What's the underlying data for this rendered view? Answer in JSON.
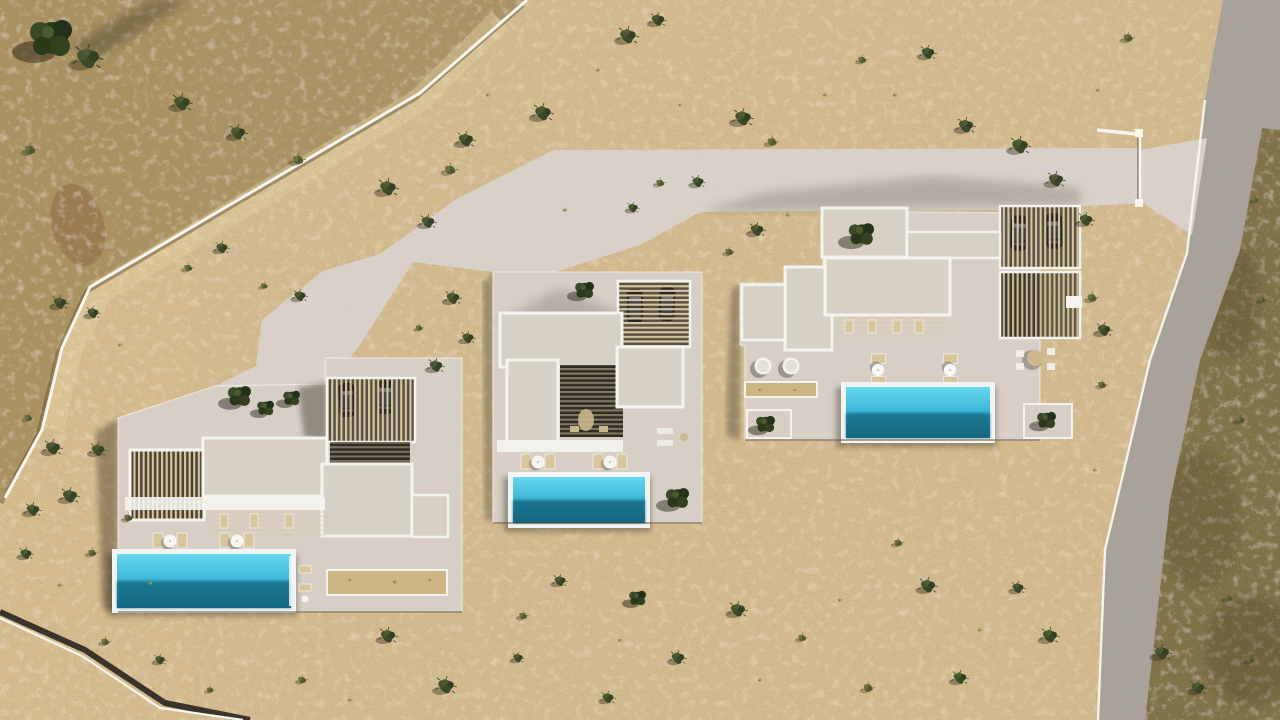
{
  "meta": {
    "title": "Aerial site plan render - three luxury villas with pools",
    "description": "Top-down architectural rendering of a desert plot with three white flat-roof villas, each with a turquoise swimming pool, louvered carport with two cars, sun loungers, a shared light-concrete driveway, white boundary walls and an asphalt access road on the right."
  },
  "palette": {
    "sand": "#d8be90",
    "sandOuter": "#ab9260",
    "scrub": "#7d6c40",
    "road": "#a7a199",
    "drive": "#dbd3cb",
    "platform": "#d7cfc6",
    "roof": "#d6d0c5",
    "frame": "#f5f3ee",
    "slat": "#d8c79e",
    "court": "#2e2b25",
    "carbase": "#454034",
    "poolHi": "#68d7ee",
    "poolMid": "#35b2d4",
    "poolDeep": "#156881",
    "rim": "#f2f4f3",
    "gravel": "#cdb483",
    "wall": "#f8f5ef",
    "bush": "#3c4a29",
    "bushLite": "#46552f",
    "olive": "#5a6334",
    "tuft": "#9a975f",
    "tree": "#2e3b1f",
    "car": "#242428"
  },
  "scene": {
    "villa_count": 3,
    "villas": [
      {
        "name": "villa-west",
        "pool": {
          "x": 112,
          "y": 549,
          "w": 184,
          "h": 64
        },
        "cars": 2,
        "sun_lounger_groups": 2
      },
      {
        "name": "villa-center",
        "pool": {
          "x": 508,
          "y": 472,
          "w": 142,
          "h": 56
        },
        "cars": 2,
        "sun_lounger_groups": 2
      },
      {
        "name": "villa-east",
        "pool": {
          "x": 841,
          "y": 382,
          "w": 154,
          "h": 61
        },
        "cars": 2,
        "sun_lounger_groups": 2
      }
    ],
    "vegetation": [
      [
        52,
        38,
        2.0,
        "tree"
      ],
      [
        88,
        58,
        1.4,
        "bush"
      ],
      [
        30,
        150,
        0.8,
        "olive"
      ],
      [
        182,
        103,
        1.0,
        "bush"
      ],
      [
        238,
        133,
        0.9,
        "bush"
      ],
      [
        298,
        160,
        0.8,
        "olive"
      ],
      [
        388,
        188,
        1.0,
        "bush"
      ],
      [
        428,
        222,
        0.8,
        "bush"
      ],
      [
        466,
        140,
        0.9,
        "bush"
      ],
      [
        450,
        170,
        0.8,
        "olive"
      ],
      [
        543,
        113,
        1.0,
        "bush"
      ],
      [
        628,
        36,
        1.0,
        "bush"
      ],
      [
        658,
        20,
        0.8,
        "bush"
      ],
      [
        743,
        118,
        1.0,
        "bush"
      ],
      [
        772,
        142,
        0.7,
        "olive"
      ],
      [
        698,
        182,
        0.7,
        "bush"
      ],
      [
        660,
        183,
        0.6,
        "olive"
      ],
      [
        633,
        208,
        0.6,
        "bush"
      ],
      [
        565,
        210,
        0.5,
        "tuft"
      ],
      [
        488,
        95,
        0.5,
        "tuft"
      ],
      [
        598,
        70,
        0.5,
        "tuft"
      ],
      [
        680,
        105,
        0.4,
        "tuft"
      ],
      [
        825,
        95,
        0.5,
        "tuft"
      ],
      [
        862,
        60,
        0.6,
        "olive"
      ],
      [
        895,
        95,
        0.5,
        "tuft"
      ],
      [
        928,
        53,
        0.8,
        "bush"
      ],
      [
        966,
        126,
        0.9,
        "bush"
      ],
      [
        1020,
        146,
        1.0,
        "bush"
      ],
      [
        1056,
        180,
        0.9,
        "bush"
      ],
      [
        1086,
        220,
        0.8,
        "bush"
      ],
      [
        1128,
        38,
        0.7,
        "olive"
      ],
      [
        1098,
        90,
        0.5,
        "tuft"
      ],
      [
        1104,
        330,
        0.8,
        "bush"
      ],
      [
        1092,
        298,
        0.7,
        "olive"
      ],
      [
        1102,
        385,
        0.6,
        "olive"
      ],
      [
        1095,
        470,
        0.5,
        "tuft"
      ],
      [
        757,
        230,
        0.8,
        "bush"
      ],
      [
        729,
        252,
        0.6,
        "olive"
      ],
      [
        788,
        215,
        0.5,
        "tuft"
      ],
      [
        453,
        298,
        0.8,
        "bush"
      ],
      [
        468,
        338,
        0.7,
        "bush"
      ],
      [
        436,
        366,
        0.8,
        "bush"
      ],
      [
        419,
        328,
        0.5,
        "olive"
      ],
      [
        300,
        296,
        0.7,
        "bush"
      ],
      [
        264,
        286,
        0.5,
        "olive"
      ],
      [
        240,
        396,
        1.1,
        "tree"
      ],
      [
        266,
        408,
        0.8,
        "tree"
      ],
      [
        292,
        398,
        0.8,
        "tree"
      ],
      [
        585,
        290,
        0.9,
        "tree"
      ],
      [
        678,
        498,
        1.1,
        "tree"
      ],
      [
        638,
        598,
        0.8,
        "tree"
      ],
      [
        862,
        234,
        1.2,
        "tree"
      ],
      [
        766,
        424,
        0.9,
        "tree"
      ],
      [
        1047,
        420,
        0.9,
        "tree"
      ],
      [
        60,
        303,
        0.8,
        "bush"
      ],
      [
        93,
        313,
        0.7,
        "bush"
      ],
      [
        28,
        418,
        0.6,
        "olive"
      ],
      [
        222,
        248,
        0.7,
        "bush"
      ],
      [
        188,
        268,
        0.6,
        "olive"
      ],
      [
        120,
        345,
        0.5,
        "tuft"
      ],
      [
        53,
        448,
        0.9,
        "bush"
      ],
      [
        98,
        450,
        0.8,
        "bush"
      ],
      [
        70,
        496,
        0.9,
        "bush"
      ],
      [
        33,
        510,
        0.8,
        "bush"
      ],
      [
        128,
        518,
        0.6,
        "olive"
      ],
      [
        26,
        554,
        0.7,
        "bush"
      ],
      [
        92,
        553,
        0.6,
        "olive"
      ],
      [
        150,
        583,
        0.5,
        "tuft"
      ],
      [
        60,
        585,
        0.5,
        "tuft"
      ],
      [
        105,
        642,
        0.6,
        "olive"
      ],
      [
        160,
        660,
        0.6,
        "bush"
      ],
      [
        210,
        690,
        0.5,
        "olive"
      ],
      [
        302,
        680,
        0.6,
        "olive"
      ],
      [
        350,
        700,
        0.5,
        "tuft"
      ],
      [
        388,
        636,
        0.9,
        "bush"
      ],
      [
        446,
        686,
        1.0,
        "bush"
      ],
      [
        523,
        616,
        0.6,
        "olive"
      ],
      [
        560,
        581,
        0.7,
        "bush"
      ],
      [
        518,
        658,
        0.6,
        "bush"
      ],
      [
        608,
        698,
        0.7,
        "bush"
      ],
      [
        678,
        658,
        0.8,
        "bush"
      ],
      [
        738,
        610,
        0.9,
        "bush"
      ],
      [
        802,
        638,
        0.6,
        "olive"
      ],
      [
        928,
        586,
        0.9,
        "bush"
      ],
      [
        898,
        543,
        0.6,
        "olive"
      ],
      [
        1018,
        588,
        0.7,
        "bush"
      ],
      [
        1050,
        636,
        0.9,
        "bush"
      ],
      [
        960,
        678,
        0.8,
        "bush"
      ],
      [
        868,
        688,
        0.7,
        "olive"
      ],
      [
        620,
        640,
        0.5,
        "tuft"
      ],
      [
        760,
        680,
        0.5,
        "tuft"
      ],
      [
        840,
        600,
        0.5,
        "tuft"
      ],
      [
        980,
        630,
        0.5,
        "tuft"
      ],
      [
        350,
        580,
        0.4,
        "tuft"
      ],
      [
        395,
        582,
        0.5,
        "tuft"
      ],
      [
        430,
        580,
        0.4,
        "tuft"
      ],
      [
        760,
        390,
        0.35,
        "tuft"
      ],
      [
        795,
        390,
        0.35,
        "tuft"
      ],
      [
        1162,
        653,
        0.9,
        "bush"
      ],
      [
        1198,
        688,
        0.8,
        "bush"
      ],
      [
        1228,
        598,
        0.6,
        "olive"
      ],
      [
        1250,
        660,
        0.6,
        "olive"
      ],
      [
        1240,
        420,
        0.6,
        "olive"
      ],
      [
        1262,
        300,
        0.5,
        "olive"
      ],
      [
        1255,
        200,
        0.5,
        "olive"
      ]
    ]
  }
}
